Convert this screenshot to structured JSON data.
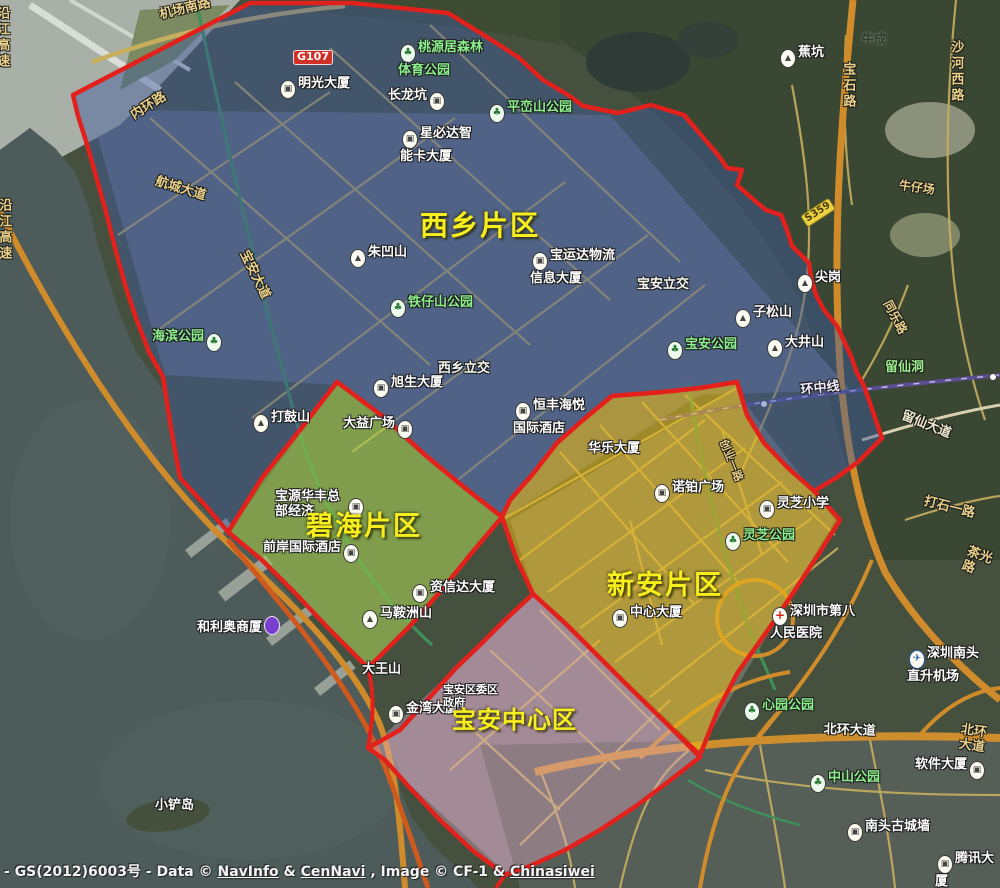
{
  "map": {
    "regions": [
      {
        "name": "xixiang",
        "label": "西乡片区",
        "fill": "rgba(62,92,160,0.45)",
        "stroke": "#e2201c"
      },
      {
        "name": "bihai",
        "label": "碧海片区",
        "fill": "rgba(160,208,70,0.50)",
        "stroke": "#e2201c"
      },
      {
        "name": "xinan",
        "label": "新安片区",
        "fill": "rgba(234,186,26,0.55)",
        "stroke": "#e2201c"
      },
      {
        "name": "baoan-center",
        "label": "宝安中心区",
        "fill": "rgba(226,172,198,0.40)",
        "stroke": "#e2201c"
      }
    ],
    "labels": [
      {
        "name": "label-mingguang-dasha",
        "text": "明光大厦",
        "x": 278,
        "y": 76,
        "type": "poi",
        "icon": "building"
      },
      {
        "name": "label-changlongkeng",
        "text": "长龙坑",
        "x": 388,
        "y": 88,
        "type": "poi",
        "icon": "building",
        "icon_side": "right"
      },
      {
        "name": "label-jiaokeng",
        "text": "蕉坑",
        "x": 778,
        "y": 45,
        "type": "poi",
        "icon": "mountain"
      },
      {
        "name": "label-niucheng",
        "text": "牛成",
        "x": 862,
        "y": 32,
        "type": "dark",
        "size": 12
      },
      {
        "name": "label-xingbida-tower",
        "text": "星必达智\n能卡大厦",
        "x": 400,
        "y": 126,
        "type": "poi",
        "icon": "building"
      },
      {
        "name": "label-zhuaoshan",
        "text": "朱凹山",
        "x": 348,
        "y": 245,
        "type": "poi",
        "icon": "mountain"
      },
      {
        "name": "label-baoyunda-logistics",
        "text": "宝运达物流\n信息大厦",
        "x": 530,
        "y": 248,
        "type": "poi",
        "icon": "building"
      },
      {
        "name": "label-baoan-interchange",
        "text": "宝安立交",
        "x": 637,
        "y": 277,
        "type": "roadwhite"
      },
      {
        "name": "label-jiangang",
        "text": "尖岗",
        "x": 795,
        "y": 270,
        "type": "poi",
        "icon": "mountain"
      },
      {
        "name": "label-zisongshan",
        "text": "子松山",
        "x": 733,
        "y": 305,
        "type": "poi",
        "icon": "mountain"
      },
      {
        "name": "label-dajingshan",
        "text": "大井山",
        "x": 765,
        "y": 335,
        "type": "poi",
        "icon": "mountain"
      },
      {
        "name": "label-dagushan",
        "text": "打鼓山",
        "x": 251,
        "y": 410,
        "type": "poi",
        "icon": "mountain"
      },
      {
        "name": "label-xusheng-dasha",
        "text": "旭生大厦",
        "x": 371,
        "y": 375,
        "type": "poi",
        "icon": "building"
      },
      {
        "name": "label-dayi-guangchang",
        "text": "大益广场",
        "x": 343,
        "y": 416,
        "type": "poi",
        "icon": "building",
        "icon_side": "right"
      },
      {
        "name": "label-xixiang-interchange",
        "text": "西乡立交",
        "x": 438,
        "y": 361,
        "type": "roadwhite"
      },
      {
        "name": "label-hengfeng-haiyue-hotel",
        "text": "恒丰海悦\n国际酒店",
        "x": 513,
        "y": 398,
        "type": "poi",
        "icon": "building"
      },
      {
        "name": "label-huale-dasha",
        "text": "华乐大厦",
        "x": 588,
        "y": 441,
        "type": "poi"
      },
      {
        "name": "label-nuobo-guangchang",
        "text": "诺铂广场",
        "x": 652,
        "y": 480,
        "type": "poi",
        "icon": "building"
      },
      {
        "name": "label-lingzhi-xiaoxue",
        "text": "灵芝小学",
        "x": 757,
        "y": 496,
        "type": "poi",
        "icon": "school"
      },
      {
        "name": "label-zhongxin-dasha",
        "text": "中心大厦",
        "x": 610,
        "y": 605,
        "type": "poi",
        "icon": "building"
      },
      {
        "name": "label-baoyuan-huafeng-hq",
        "text": "宝源华丰总\n部经济",
        "x": 275,
        "y": 489,
        "type": "poi"
      },
      {
        "name": "icon-baoyuan-huafeng",
        "text": "",
        "x": 346,
        "y": 494,
        "type": "poi",
        "icon": "building"
      },
      {
        "name": "label-qianan-intl-hotel",
        "text": "前岸国际酒店",
        "x": 263,
        "y": 540,
        "type": "poi",
        "icon": "building",
        "icon_side": "right"
      },
      {
        "name": "label-zixinda-dasha",
        "text": "资信达大厦",
        "x": 410,
        "y": 580,
        "type": "poi",
        "icon": "building"
      },
      {
        "name": "label-maanzhoushan",
        "text": "马鞍洲山",
        "x": 360,
        "y": 606,
        "type": "poi",
        "icon": "mountain"
      },
      {
        "name": "label-heliao-shangsha",
        "text": "和利奥商厦",
        "x": 197,
        "y": 616,
        "type": "poi",
        "icon": "purple",
        "icon_side": "right"
      },
      {
        "name": "label-dawangshan",
        "text": "大王山",
        "x": 362,
        "y": 662,
        "type": "poi"
      },
      {
        "name": "label-jinwan-dasha",
        "text": "金湾大厦",
        "x": 386,
        "y": 701,
        "type": "poi",
        "icon": "building"
      },
      {
        "name": "label-baoan-district-gov",
        "text": "宝安区委区\n政府",
        "x": 443,
        "y": 684,
        "type": "poi",
        "size": 11
      },
      {
        "name": "label-xiaochandao",
        "text": "小铲岛",
        "x": 155,
        "y": 798,
        "type": "poi"
      },
      {
        "name": "label-no8-peoples-hospital",
        "text": "深圳市第八\n人民医院",
        "x": 770,
        "y": 604,
        "type": "poi",
        "icon": "hospital"
      },
      {
        "name": "label-nantou-heliport",
        "text": "深圳南头\n直升机场",
        "x": 907,
        "y": 646,
        "type": "poi",
        "icon": "plane"
      },
      {
        "name": "label-ruanjian-dasha",
        "text": "软件大厦",
        "x": 915,
        "y": 757,
        "type": "poi",
        "icon": "building",
        "icon_side": "right"
      },
      {
        "name": "label-tengxun-dasha",
        "text": "腾讯大厦",
        "x": 935,
        "y": 851,
        "type": "poi",
        "icon": "building"
      },
      {
        "name": "label-nantou-gucheng",
        "text": "南头古城墙",
        "x": 845,
        "y": 819,
        "type": "poi",
        "icon": "building"
      },
      {
        "name": "label-taoyuanju-sports-park",
        "text": "桃源居森林\n体育公园",
        "x": 398,
        "y": 40,
        "type": "park",
        "icon": "park"
      },
      {
        "name": "label-pingluanshan-park",
        "text": "平峦山公园",
        "x": 487,
        "y": 100,
        "type": "park",
        "icon": "park"
      },
      {
        "name": "label-tiezishan-park",
        "text": "铁仔山公园",
        "x": 388,
        "y": 295,
        "type": "park",
        "icon": "park"
      },
      {
        "name": "label-haibin-park",
        "text": "海滨公园",
        "x": 152,
        "y": 329,
        "type": "park",
        "icon": "park",
        "icon_side": "right"
      },
      {
        "name": "label-baoan-park",
        "text": "宝安公园",
        "x": 665,
        "y": 337,
        "type": "park",
        "icon": "park"
      },
      {
        "name": "label-lingzhi-park",
        "text": "灵芝公园",
        "x": 723,
        "y": 528,
        "type": "park",
        "icon": "park"
      },
      {
        "name": "label-xinyuan-park",
        "text": "心园公园",
        "x": 742,
        "y": 698,
        "type": "park",
        "icon": "park"
      },
      {
        "name": "label-zhongshan-park",
        "text": "中山公园",
        "x": 808,
        "y": 770,
        "type": "park",
        "icon": "park"
      },
      {
        "name": "label-liuxiandong",
        "text": "留仙洞",
        "x": 885,
        "y": 360,
        "type": "greenplace"
      },
      {
        "name": "road-jichang-nanlu",
        "text": "机场南路",
        "x": 158,
        "y": 8,
        "type": "gold",
        "rot": -14
      },
      {
        "name": "road-neihuanlu",
        "text": "内环路",
        "x": 128,
        "y": 110,
        "type": "gold",
        "rot": -32
      },
      {
        "name": "road-hangcheng-dadao",
        "text": "航城大道",
        "x": 158,
        "y": 174,
        "type": "gold",
        "rot": 17
      },
      {
        "name": "road-baoan-dadao",
        "text": "宝安大道",
        "x": 250,
        "y": 248,
        "type": "gold",
        "rot": 64
      },
      {
        "name": "road-yanjiang-gaosu",
        "text": "沿江高速",
        "x": -4,
        "y": 198,
        "type": "gold",
        "vert": true
      },
      {
        "name": "road-yanjiang-gaosu-2",
        "text": "沿江高速",
        "x": -6,
        "y": 6,
        "type": "gold",
        "vert": true
      },
      {
        "name": "road-baoshilu",
        "text": "宝石路",
        "x": 840,
        "y": 62,
        "type": "gold",
        "vert": true
      },
      {
        "name": "road-shahexilu",
        "text": "沙河西路",
        "x": 948,
        "y": 40,
        "type": "gold",
        "vert": true
      },
      {
        "name": "road-tonglelu",
        "text": "同乐路",
        "x": 893,
        "y": 298,
        "type": "gold",
        "rot": 62,
        "size": 12
      },
      {
        "name": "road-liuxian-dadao",
        "text": "留仙大道",
        "x": 905,
        "y": 408,
        "type": "roadlight",
        "rot": 22
      },
      {
        "name": "road-dashi-yilu",
        "text": "打石一路",
        "x": 926,
        "y": 494,
        "type": "gold",
        "rot": 14
      },
      {
        "name": "road-chaguanglu",
        "text": "茶光路",
        "x": 970,
        "y": 544,
        "type": "gold",
        "rot": 20
      },
      {
        "name": "road-beihuan-dadao",
        "text": "北环大道",
        "x": 824,
        "y": 722,
        "type": "roadwhite",
        "rot": 2
      },
      {
        "name": "road-beihuan-dadao-2",
        "text": "北环大道",
        "x": 962,
        "y": 722,
        "type": "gold",
        "rot": 8
      },
      {
        "name": "road-chuangye-yilu",
        "text": "创业一路",
        "x": 728,
        "y": 438,
        "type": "gold",
        "rot": 68,
        "size": 11
      },
      {
        "name": "label-niuzaichang",
        "text": "牛仔场",
        "x": 900,
        "y": 178,
        "type": "gold",
        "rot": 8,
        "size": 12
      },
      {
        "name": "label-huanzhongxian-metro",
        "text": "环中线",
        "x": 800,
        "y": 383,
        "type": "metro",
        "rot": -6
      },
      {
        "name": "badge-g107",
        "text": "G107",
        "x": 293,
        "y": 50,
        "type": "badgered"
      },
      {
        "name": "badge-s359",
        "text": "S359",
        "x": 800,
        "y": 216,
        "type": "badgeyellow",
        "rot": -33
      }
    ],
    "attribution": {
      "segments": [
        {
          "t": "- GS(2012)6003号 - Data © ",
          "u": false
        },
        {
          "t": "NavInfo",
          "u": true
        },
        {
          "t": " & ",
          "u": false
        },
        {
          "t": "CenNavi",
          "u": true
        },
        {
          "t": " , Image © CF-1 & ",
          "u": false
        },
        {
          "t": "Chinasiwei",
          "u": true
        }
      ]
    }
  }
}
